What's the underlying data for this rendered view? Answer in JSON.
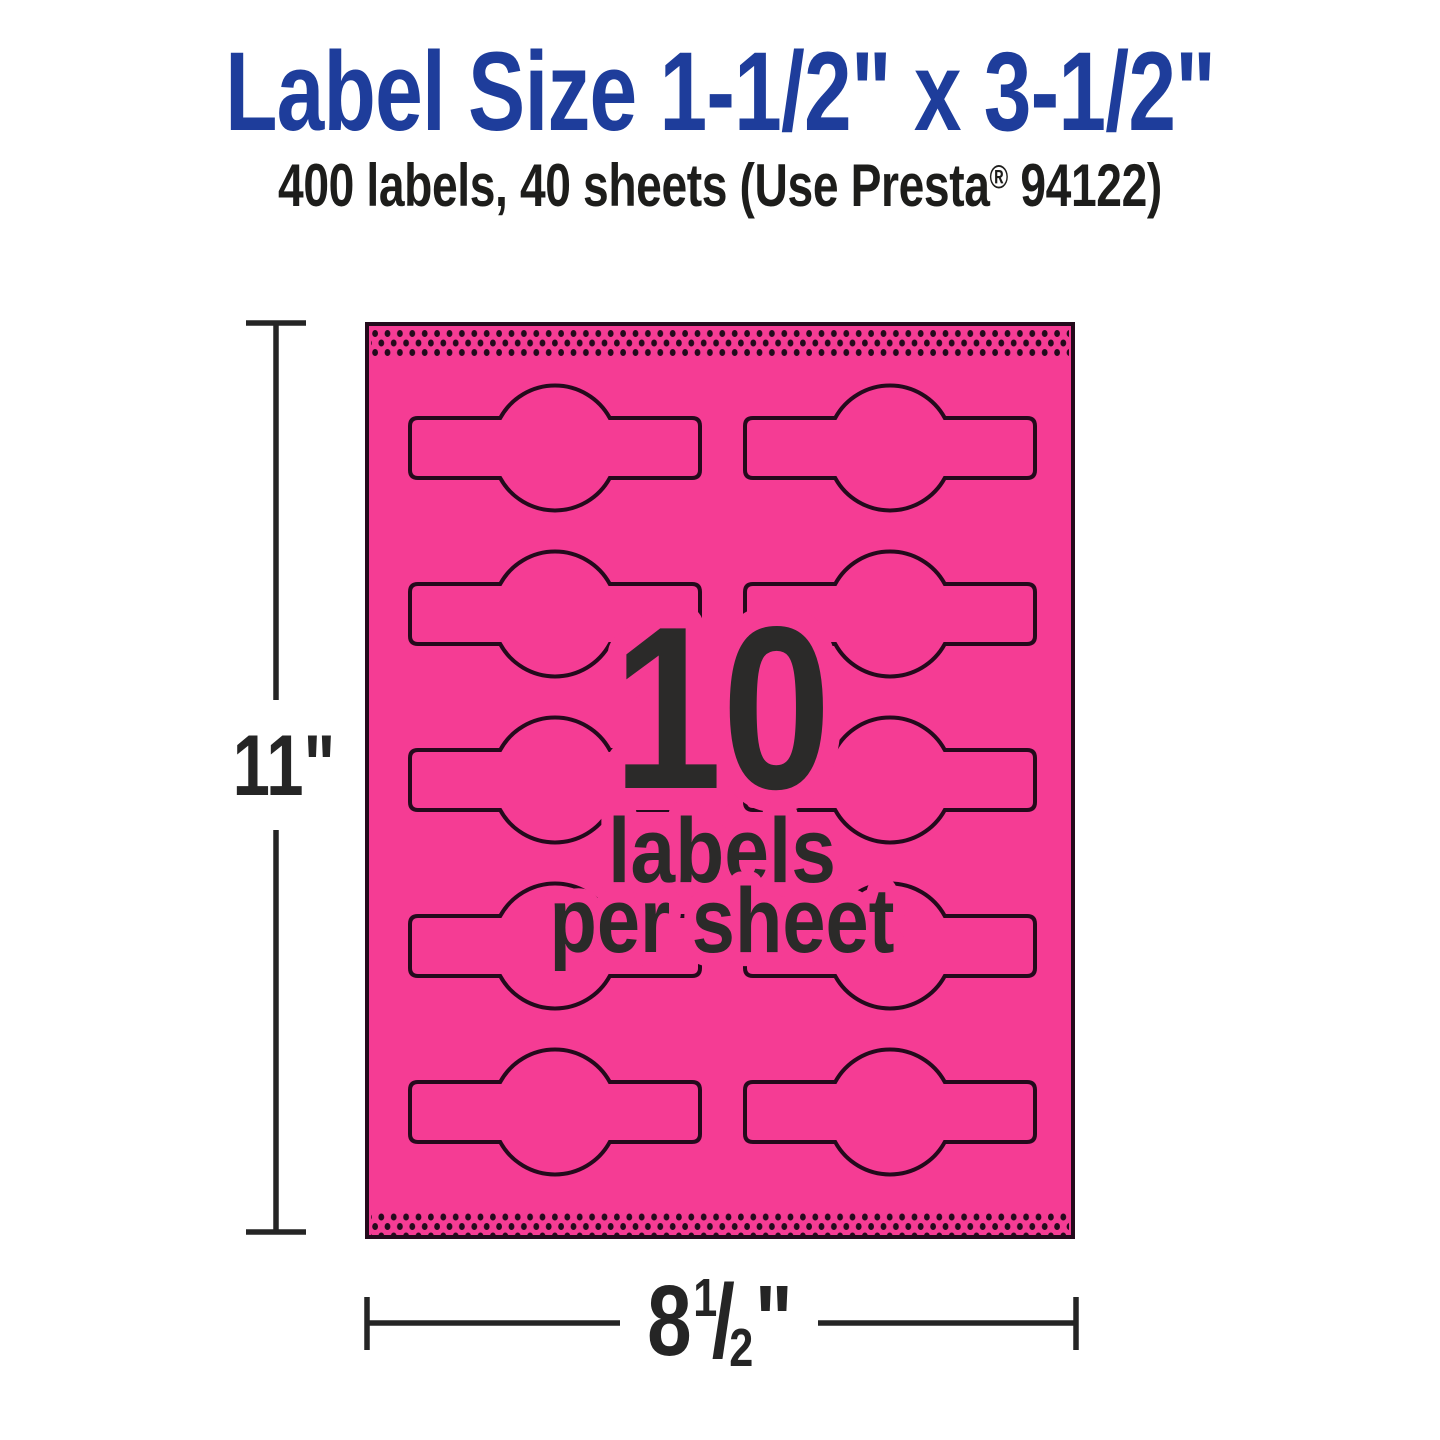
{
  "title": "Label Size 1-1/2\" x 3-1/2\"",
  "subtitle": {
    "prefix": "400 labels, 40 sheets (Use Presta",
    "registered": "®",
    "suffix": " 94122)"
  },
  "sheet": {
    "count": "10",
    "caption_line1": "labels",
    "caption_line2": "per sheet",
    "labels_per_sheet": 10,
    "columns": 2,
    "rows": 5
  },
  "dimensions": {
    "height_label": "11\"",
    "width_whole": "8",
    "width_frac_numerator": "1",
    "width_frac_denominator": "2",
    "width_unit": "\""
  },
  "colors": {
    "pink": "#f53c94",
    "outline": "#240a1c",
    "blue": "#1e3d9b",
    "dark": "#2b2a29",
    "dim": "#252525"
  }
}
